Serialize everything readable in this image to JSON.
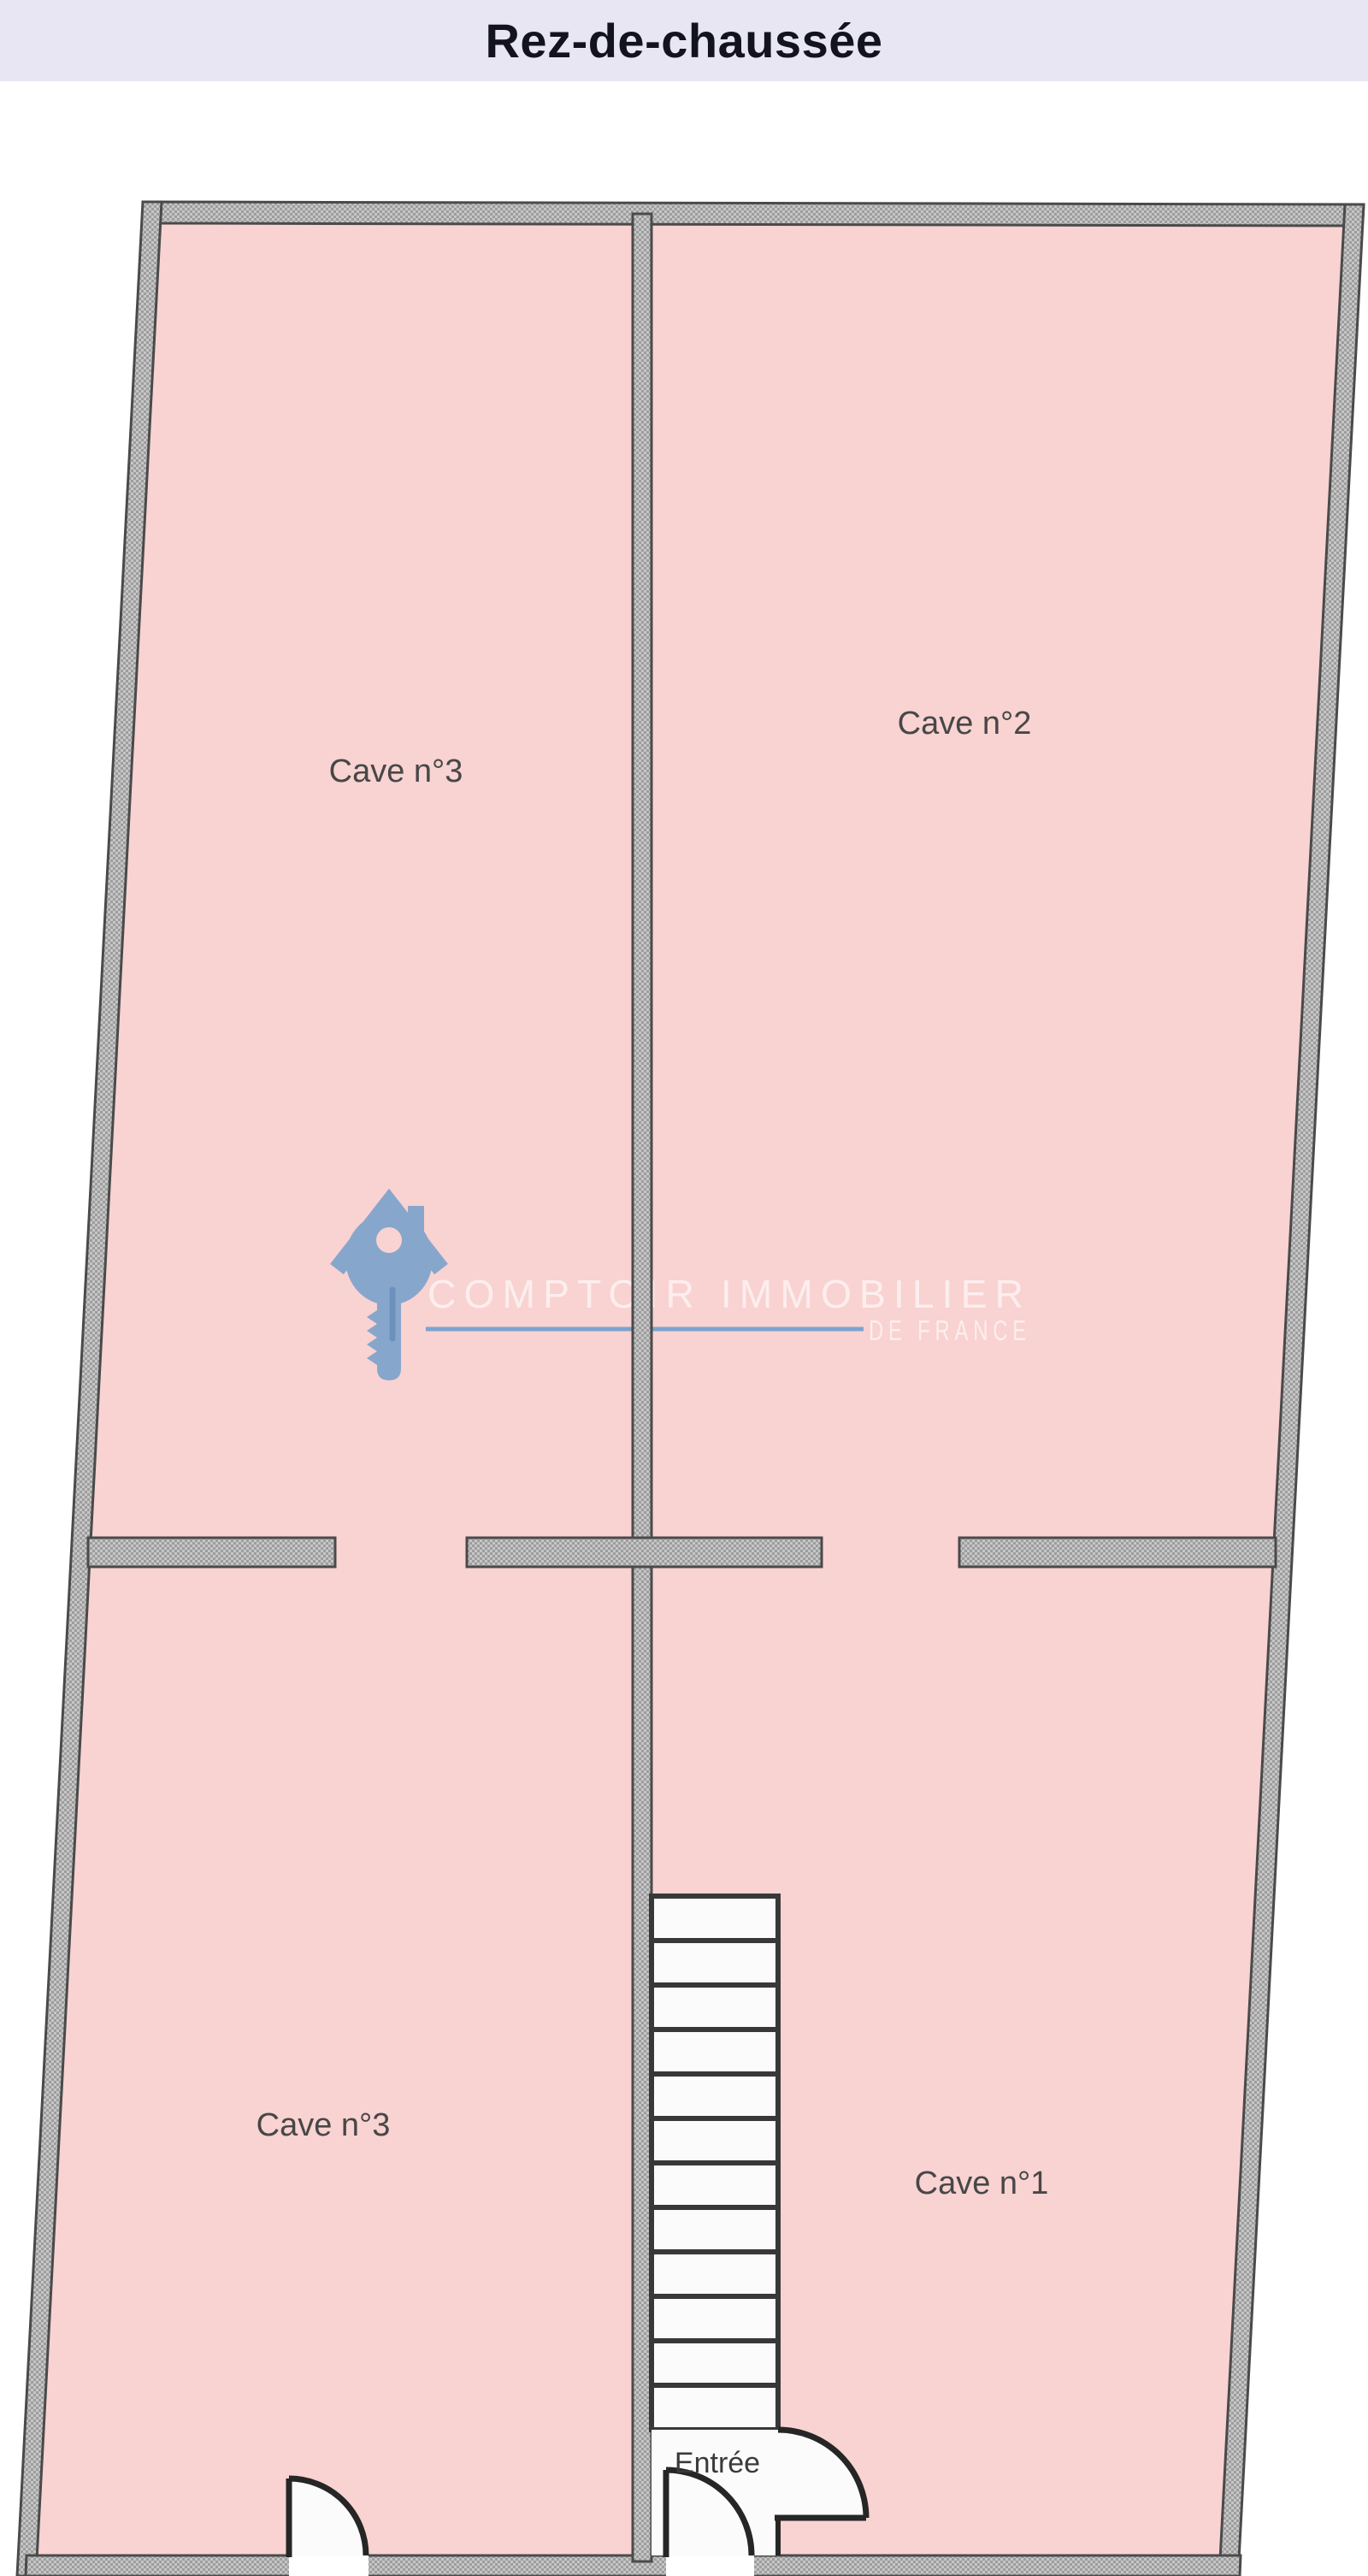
{
  "header": {
    "title": "Rez-de-chaussée",
    "background_color": "#e8e6f3",
    "text_color": "#13131f"
  },
  "floorplan": {
    "colors": {
      "room_fill": "#f9d2d2",
      "wall_light": "#c6c6c6",
      "wall_dark": "#9d9d9d",
      "wall_edge": "#4a4a4a",
      "stair_fill": "#fbfbfb",
      "door_stroke": "#262626"
    },
    "rooms": [
      {
        "id": "cave-3-top-left",
        "label": "Cave n°3"
      },
      {
        "id": "cave-2-top-right",
        "label": "Cave n°2"
      },
      {
        "id": "cave-3-bottom-left",
        "label": "Cave n°3"
      },
      {
        "id": "cave-1-bottom-right",
        "label": "Cave n°1"
      }
    ],
    "entrance_label": "Entrée",
    "stairs": {
      "steps": 12
    }
  },
  "watermark": {
    "line1": "COMPTOIR IMMOBILIER",
    "line2": "DE FRANCE",
    "key_color": "#87a6cb",
    "underline_color": "#7ca3cf"
  }
}
